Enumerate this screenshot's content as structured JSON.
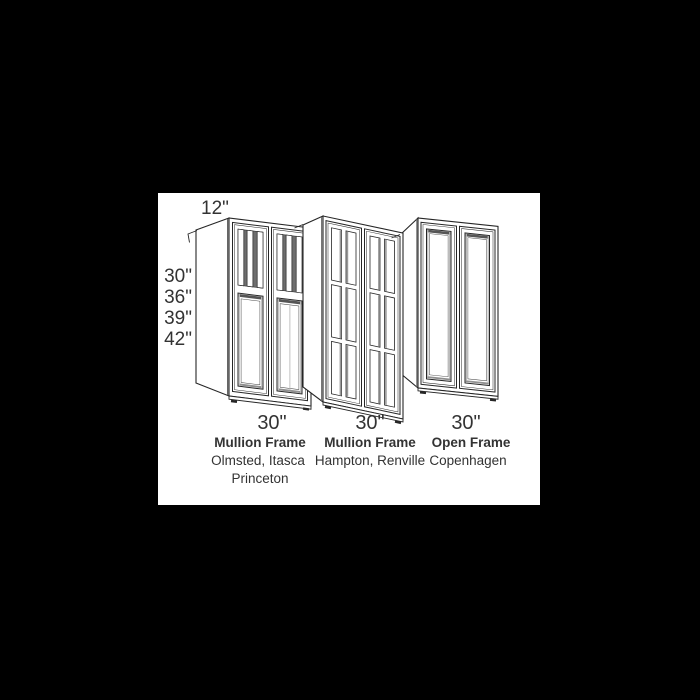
{
  "panel": {
    "page_background": "#000000",
    "background": "#ffffff"
  },
  "diagram": {
    "depth_label": "12\"",
    "height_labels": [
      "30\"",
      "36\"",
      "39\"",
      "42\""
    ],
    "cabinets": [
      {
        "width_label": "30\"",
        "frame_type": "Mullion Frame",
        "style_lines": [
          "Olmsted, Itasca",
          "Princeton"
        ]
      },
      {
        "width_label": "30\"",
        "frame_type": "Mullion Frame",
        "style_lines": [
          "Hampton, Renville"
        ]
      },
      {
        "width_label": "30\"",
        "frame_type": "Open Frame",
        "style_lines": [
          "Copenhagen"
        ]
      }
    ],
    "colors": {
      "line": "#262626",
      "text": "#333333",
      "shadow_dark": "#555555",
      "shadow_mid": "#6e6e6e",
      "shadow_light": "#c0c0c0"
    }
  }
}
